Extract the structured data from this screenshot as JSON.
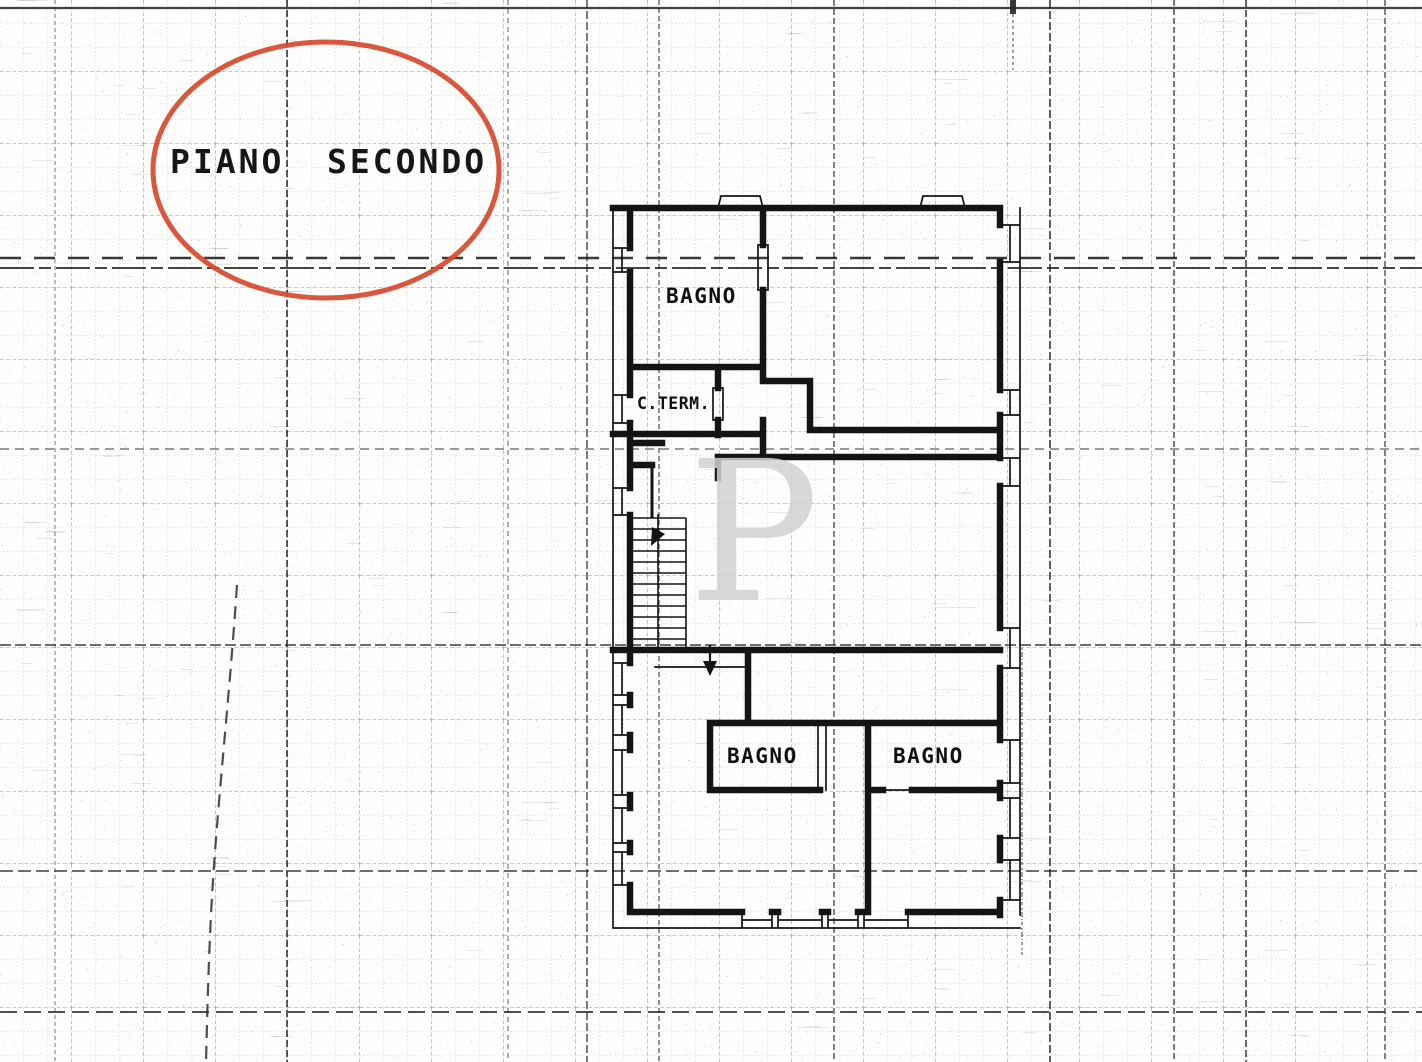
{
  "paper": {
    "background": "#fdfdfb",
    "grid_color": "#555555",
    "ink_color": "#161616"
  },
  "annotation": {
    "word1": "PIANO",
    "word2": "SECONDO",
    "ellipse_color": "#d7492e"
  },
  "floor_plan": {
    "labels": {
      "bagno_top": "BAGNO",
      "c_term": "C.TERM.",
      "bagno_left": "BAGNO",
      "bagno_right": "BAGNO"
    },
    "watermark_letter": "P"
  }
}
